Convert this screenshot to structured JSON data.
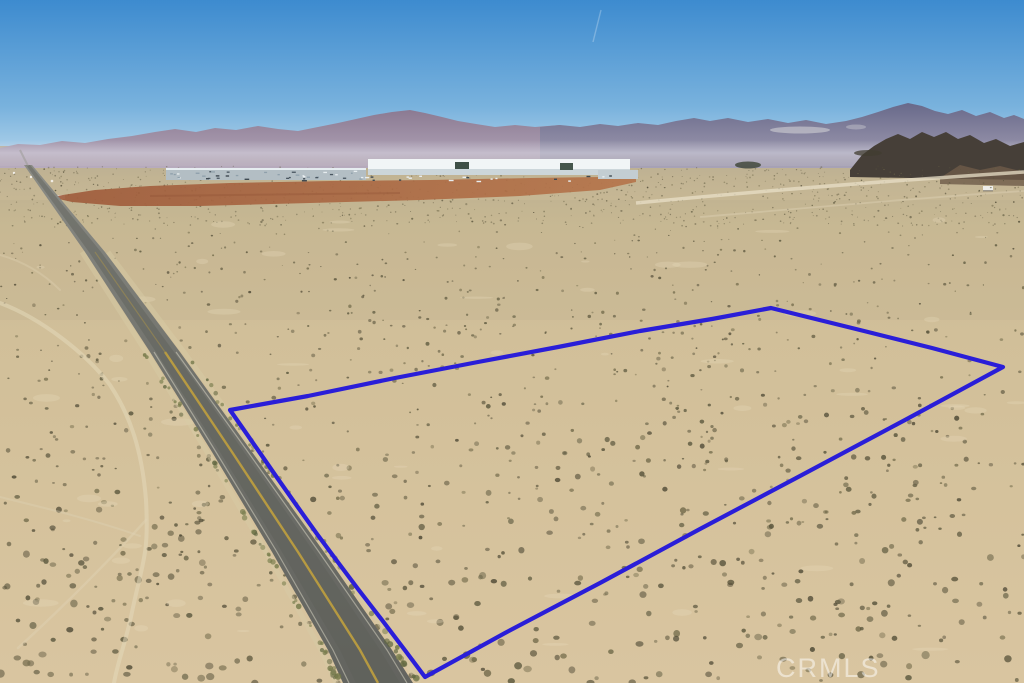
{
  "photo": {
    "kind": "aerial-drone-photo",
    "subject": "vacant desert land parcel with highlighted lot boundary beside a two-lane highway, industrial warehouses and mountains on the horizon"
  },
  "watermark": {
    "text": "CRMLS",
    "color": "#ffffff",
    "opacity": 0.5
  },
  "boundary": {
    "color": "#2a1ed8",
    "stroke_width": 4.2,
    "points": [
      [
        230,
        410
      ],
      [
        308,
        396
      ],
      [
        395,
        378
      ],
      [
        478,
        362
      ],
      [
        558,
        347
      ],
      [
        640,
        331
      ],
      [
        712,
        319
      ],
      [
        771,
        308
      ],
      [
        860,
        330
      ],
      [
        932,
        348
      ],
      [
        1003,
        367
      ],
      [
        905,
        420
      ],
      [
        800,
        476
      ],
      [
        700,
        529
      ],
      [
        600,
        583
      ],
      [
        505,
        633
      ],
      [
        425,
        677
      ],
      [
        404,
        649
      ],
      [
        382,
        620
      ],
      [
        358,
        589
      ],
      [
        337,
        561
      ],
      [
        317,
        534
      ],
      [
        297,
        506
      ],
      [
        278,
        479
      ],
      [
        260,
        453
      ],
      [
        244,
        430
      ],
      [
        230,
        410
      ]
    ]
  },
  "scene": {
    "sky": {
      "top": "#3d8bcf",
      "mid": "#8fc0e2",
      "horizon": "#cfe3f2"
    },
    "mountains": {
      "left": "#8b7a92",
      "left_base": "#b7abbd",
      "right": "#68698a",
      "right_base": "#a7a2b6",
      "dark_ridge": "#463f38"
    },
    "desert": {
      "sand_far": "#b4aa93",
      "sand_mid": "#d1bf99",
      "sand_near": "#d9c5a0",
      "shrub_colors": [
        "#6a6349",
        "#59543c",
        "#4f4a36",
        "#766e4e",
        "#5e5a40"
      ],
      "patch_color": "#e7dcbd",
      "trail_color": "#e4d8ba"
    },
    "graded_dirt": {
      "left": "#9e5a3a",
      "right": "#b5744a"
    },
    "industrial": {
      "roof": "#f1f5f6",
      "face": "#ccd6da",
      "yard": "#b3bec4",
      "dark_unit": "#3e4f46"
    },
    "road": {
      "surface_top": "#8b8c86",
      "surface_bottom": "#63645f",
      "center_line": "#c5a33c",
      "edge_line": "#ddd9c8",
      "shoulder": "#d8cba6",
      "bush_colors": [
        "#737748",
        "#5f6540",
        "#7b7f4f"
      ]
    }
  }
}
